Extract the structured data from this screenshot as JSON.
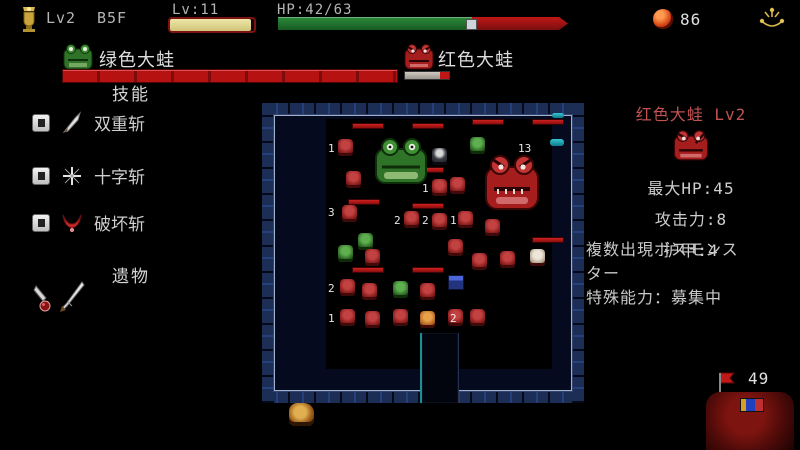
{
  "colors": {
    "hp_green": "#2c8c3c",
    "hp_red": "#b61212",
    "enemy_title": "#c05252",
    "gold": "#d8b84a"
  },
  "hud": {
    "rank_label": "Lv2",
    "floor_label": "B5F",
    "level_label": "Lv:11",
    "level_percent": 96,
    "hp_label": "HP:42/63",
    "hp_percent": 67,
    "coin_count": "86"
  },
  "allies": [
    {
      "name": "绿色大蛙",
      "hp_percent": 100
    },
    {
      "name": "红色大蛙",
      "hp_percent": 20
    }
  ],
  "skills": {
    "header": "技能",
    "items": [
      {
        "name": "双重斩"
      },
      {
        "name": "十字斩"
      },
      {
        "name": "破坏斩"
      }
    ]
  },
  "relics": {
    "header": "遗物"
  },
  "enemy_panel": {
    "title": "红色大蛙 Lv2",
    "stats": [
      {
        "text": "最大HP:45"
      },
      {
        "text": "攻击力:8"
      },
      {
        "text": "护甲:4"
      }
    ],
    "description_lines": [
      {
        "text": "複数出現ボスモンス"
      },
      {
        "text": "ター"
      },
      {
        "text": "特殊能力：募集中"
      }
    ]
  },
  "bottom_right": {
    "flag_count": "49"
  },
  "map": {
    "entities": [
      {
        "t": "floor",
        "x": 64,
        "y": 16,
        "w": 226,
        "h": 250
      },
      {
        "t": "bar",
        "x": 90,
        "y": 20,
        "w": 30,
        "h": 4
      },
      {
        "t": "bar",
        "x": 150,
        "y": 20,
        "w": 30,
        "h": 4
      },
      {
        "t": "bar",
        "x": 210,
        "y": 16,
        "w": 30,
        "h": 4
      },
      {
        "t": "bar",
        "x": 270,
        "y": 16,
        "w": 30,
        "h": 4
      },
      {
        "t": "bar",
        "x": 150,
        "y": 64,
        "w": 30,
        "h": 4
      },
      {
        "t": "bar",
        "x": 86,
        "y": 96,
        "w": 30,
        "h": 4
      },
      {
        "t": "bar",
        "x": 150,
        "y": 100,
        "w": 30,
        "h": 4
      },
      {
        "t": "bar",
        "x": 90,
        "y": 164,
        "w": 30,
        "h": 4
      },
      {
        "t": "bar",
        "x": 150,
        "y": 164,
        "w": 30,
        "h": 4
      },
      {
        "t": "bar",
        "x": 270,
        "y": 134,
        "w": 30,
        "h": 4
      },
      {
        "t": "mob",
        "x": 76,
        "y": 36,
        "w": 15,
        "h": 17,
        "k": "red"
      },
      {
        "t": "mob",
        "x": 84,
        "y": 68,
        "w": 15,
        "h": 17,
        "k": "red"
      },
      {
        "t": "mob",
        "x": 80,
        "y": 102,
        "w": 15,
        "h": 17,
        "k": "red"
      },
      {
        "t": "mob",
        "x": 96,
        "y": 130,
        "w": 15,
        "h": 17,
        "k": "green"
      },
      {
        "t": "mob",
        "x": 170,
        "y": 45,
        "w": 15,
        "h": 17,
        "k": "dark"
      },
      {
        "t": "mob",
        "x": 208,
        "y": 34,
        "w": 15,
        "h": 17,
        "k": "green"
      },
      {
        "t": "mob",
        "x": 170,
        "y": 76,
        "w": 15,
        "h": 17,
        "k": "red"
      },
      {
        "t": "mob",
        "x": 188,
        "y": 74,
        "w": 15,
        "h": 17,
        "k": "red"
      },
      {
        "t": "mob",
        "x": 142,
        "y": 108,
        "w": 15,
        "h": 17,
        "k": "red"
      },
      {
        "t": "mob",
        "x": 170,
        "y": 110,
        "w": 15,
        "h": 17,
        "k": "red"
      },
      {
        "t": "mob",
        "x": 196,
        "y": 108,
        "w": 15,
        "h": 17,
        "k": "red"
      },
      {
        "t": "mob",
        "x": 223,
        "y": 116,
        "w": 15,
        "h": 17,
        "k": "red"
      },
      {
        "t": "mob",
        "x": 76,
        "y": 142,
        "w": 15,
        "h": 17,
        "k": "green"
      },
      {
        "t": "mob",
        "x": 103,
        "y": 146,
        "w": 15,
        "h": 17,
        "k": "red"
      },
      {
        "t": "mob",
        "x": 78,
        "y": 176,
        "w": 15,
        "h": 17,
        "k": "red"
      },
      {
        "t": "mob",
        "x": 100,
        "y": 180,
        "w": 15,
        "h": 17,
        "k": "red"
      },
      {
        "t": "mob",
        "x": 131,
        "y": 178,
        "w": 15,
        "h": 17,
        "k": "green"
      },
      {
        "t": "mob",
        "x": 158,
        "y": 180,
        "w": 15,
        "h": 17,
        "k": "red"
      },
      {
        "t": "mob",
        "x": 210,
        "y": 150,
        "w": 15,
        "h": 17,
        "k": "red"
      },
      {
        "t": "mob",
        "x": 238,
        "y": 148,
        "w": 15,
        "h": 17,
        "k": "red"
      },
      {
        "t": "mob",
        "x": 268,
        "y": 146,
        "w": 15,
        "h": 17,
        "k": "light"
      },
      {
        "t": "mob",
        "x": 186,
        "y": 136,
        "w": 15,
        "h": 17,
        "k": "red"
      },
      {
        "t": "mob",
        "x": 78,
        "y": 206,
        "w": 15,
        "h": 17,
        "k": "red"
      },
      {
        "t": "mob",
        "x": 103,
        "y": 208,
        "w": 15,
        "h": 17,
        "k": "red"
      },
      {
        "t": "mob",
        "x": 131,
        "y": 206,
        "w": 15,
        "h": 17,
        "k": "red"
      },
      {
        "t": "mob",
        "x": 158,
        "y": 208,
        "w": 15,
        "h": 17,
        "k": "orange"
      },
      {
        "t": "mob",
        "x": 186,
        "y": 206,
        "w": 15,
        "h": 17,
        "k": "red"
      },
      {
        "t": "mob",
        "x": 208,
        "y": 206,
        "w": 15,
        "h": 17,
        "k": "red"
      },
      {
        "t": "chest",
        "x": 186,
        "y": 172,
        "w": 14,
        "h": 13
      },
      {
        "t": "teal",
        "x": 288,
        "y": 36,
        "w": 14,
        "h": 7
      },
      {
        "t": "teal",
        "x": 290,
        "y": 10,
        "w": 12,
        "h": 5
      },
      {
        "t": "num",
        "x": 66,
        "y": 40,
        "v": "1"
      },
      {
        "t": "num",
        "x": 66,
        "y": 104,
        "v": "3"
      },
      {
        "t": "num",
        "x": 132,
        "y": 112,
        "v": "2"
      },
      {
        "t": "num",
        "x": 160,
        "y": 112,
        "v": "2"
      },
      {
        "t": "num",
        "x": 188,
        "y": 112,
        "v": "1"
      },
      {
        "t": "num",
        "x": 160,
        "y": 80,
        "v": "1"
      },
      {
        "t": "num",
        "x": 66,
        "y": 180,
        "v": "2"
      },
      {
        "t": "num",
        "x": 66,
        "y": 210,
        "v": "1"
      },
      {
        "t": "num",
        "x": 188,
        "y": 210,
        "v": "2"
      },
      {
        "t": "num",
        "x": 256,
        "y": 40,
        "v": "13"
      },
      {
        "t": "greenfrog",
        "x": 112,
        "y": 34,
        "w": 54,
        "h": 48
      },
      {
        "t": "redfrog",
        "x": 222,
        "y": 50,
        "w": 56,
        "h": 58
      },
      {
        "t": "corridor",
        "x": 158,
        "y": 230,
        "w": 36,
        "h": 70
      }
    ]
  }
}
